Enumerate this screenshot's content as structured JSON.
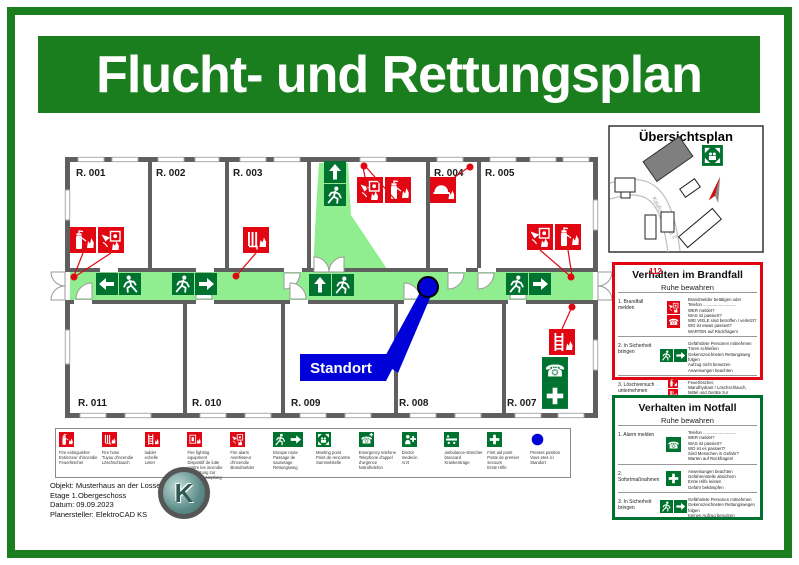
{
  "title": "Flucht- und Rettungsplan",
  "colors": {
    "frame_green": "#1b7e1e",
    "sign_green": "#007230",
    "route_green": "#90ee90",
    "alarm_red": "#e20613",
    "position_blue": "#0000d9"
  },
  "overview": {
    "title": "Übersichtsplan",
    "street": "Kaufunger Weg 2"
  },
  "floorplan": {
    "rooms": [
      "R. 001",
      "R. 002",
      "R. 003",
      "R. 004",
      "R. 005",
      "R. 011",
      "R. 010",
      "R. 009",
      "R. 008",
      "R. 007"
    ],
    "standort": "Standort"
  },
  "brandfall": {
    "title": "Verhalten im Brandfall",
    "subtitle": "Ruhe bewahren",
    "emergency_number": "112",
    "steps": [
      {
        "label": "1. Brandfall melden",
        "text": "Brandmelder betätigen oder\nTelefon ............................\nWER meldet?\nWAS ist passiert?\nWIE VIELE sind betroffen / verletzt?\nWO ist etwas passiert?\nWARTEN auf Rückfragen!"
      },
      {
        "label": "2. In Sicherheit bringen",
        "text": "Gefährdete Personen mitnehmen\nTüren schließen\nGekennzeichneten Rettungsweg folgen\nAufzug nicht benutzen\nAnweisungen beachten"
      },
      {
        "label": "3. Löschversuch unternehmen",
        "text": "Feuerlöscher,\nWandhydrant / Löschschlauch,\nMittel und Geräte zur\nBrandbekämpfung benutzen"
      }
    ]
  },
  "notfall": {
    "title": "Verhalten im Notfall",
    "subtitle": "Ruhe bewahren",
    "steps": [
      {
        "label": "1. Alarm melden",
        "text": "Telefon ............................\nWER meldet?\nWAS ist passiert?\nWO ist es passiert?\nSind Menschen in Gefahr?\nWarten auf Rückfragen!"
      },
      {
        "label": "2. Sofortmaßnahmen",
        "text": "Anweisungen beachten\nGefahrenstelle absichern\nErste Hilfe leisten\nGefahr bekämpfen"
      },
      {
        "label": "3. In Sicherheit bringen",
        "text": "Gefährdete Personen mitnehmen\nGekennzeichneten Rettungswegen folgen\nKeinen Aufzug benutzen"
      }
    ]
  },
  "legend": {
    "items": [
      {
        "name": "fire-extinguisher",
        "text": "Fire extinguisher\nExtincteur d'incendie\nFeuerlöscher"
      },
      {
        "name": "fire-hose",
        "text": "Fire hose\nTuyau d'incendie\nLöschschlauch"
      },
      {
        "name": "ladder",
        "text": "ladder\nechelle\nLeiter"
      },
      {
        "name": "fire-fighting-equipment",
        "text": "Fire fighting equipment\nDispositif de lutte contre les incendie\nEinrichtung zur Brandbekämpfung"
      },
      {
        "name": "fire-alarm",
        "text": "Fire alarm\nAvertisseur d'incendie\nBrandmelder"
      },
      {
        "name": "escape-route",
        "text": "Escape route\nPassage de sauvetage\nRettungsweg"
      },
      {
        "name": "meeting-point",
        "text": "Meeting point\nPoint de rencontre\nSammelstelle"
      },
      {
        "name": "emergency-telephone",
        "text": "Emergency telefone\nTelephone d'appel d'urgence\nNotruftelefon"
      },
      {
        "name": "doctor",
        "text": "Doctor\nmedecin\nArzt"
      },
      {
        "name": "ambulance-stretcher",
        "text": "ambulance-stretcher\nbrancard\nKrankentrage"
      },
      {
        "name": "first-aid-point",
        "text": "First aid point\nPoste de premier secours\nErste Hilfe"
      },
      {
        "name": "present-position",
        "text": "Present position\nVous etes ici\nStandort"
      }
    ]
  },
  "footer": {
    "info": "Objekt: Musterhaus an der Losse\nEtage 1.Obergeschoss\nDatum: 09.09.2023\nPlanersteller: ElektroCAD KS",
    "logo_letter": "K"
  }
}
